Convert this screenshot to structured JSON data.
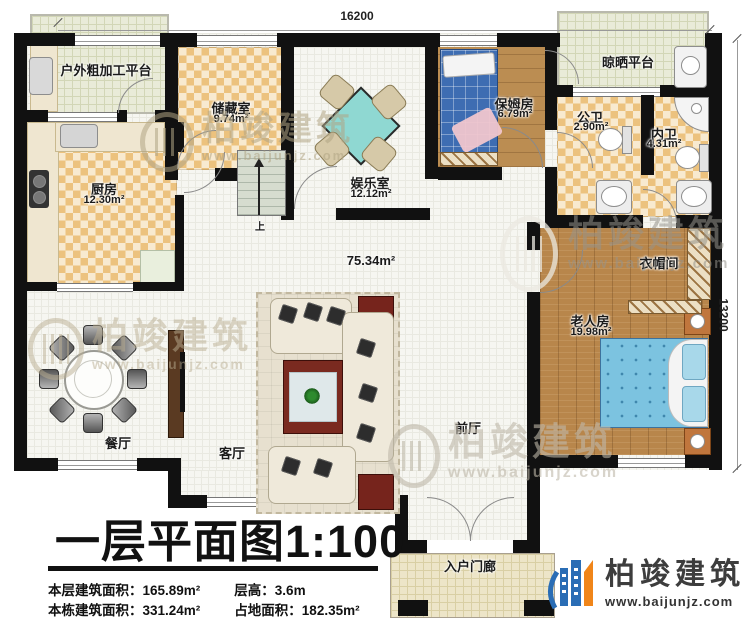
{
  "dimensions": {
    "width_label": "16200",
    "height_label": "13200"
  },
  "rooms": {
    "outdoor_platform": {
      "name": "户外粗加工平台"
    },
    "storage": {
      "name": "储藏室",
      "area": "9.74m²"
    },
    "entertainment": {
      "name": "娱乐室",
      "area": "12.12m²"
    },
    "nanny": {
      "name": "保姆房",
      "area": "6.79m²"
    },
    "drying_platform": {
      "name": "晾晒平台"
    },
    "public_bath": {
      "name": "公卫",
      "area": "2.90m²"
    },
    "inner_bath": {
      "name": "内卫",
      "area": "4.31m²"
    },
    "kitchen": {
      "name": "厨房",
      "area": "12.30m²"
    },
    "cloakroom": {
      "name": "衣帽间"
    },
    "elder_room": {
      "name": "老人房",
      "area": "19.98m²"
    },
    "hall": {
      "area": "75.34m²"
    },
    "dining": {
      "name": "餐厅"
    },
    "living": {
      "name": "客厅"
    },
    "front_hall": {
      "name": "前厅"
    },
    "porch": {
      "name": "入户门廊"
    },
    "stairs": {
      "label": "上"
    }
  },
  "title": {
    "text": "一层平面图",
    "scale": "1:100"
  },
  "stats": {
    "row1": [
      {
        "label": "本层建筑面积：",
        "value": "165.89m²"
      },
      {
        "label": "层高：",
        "value": "3.6m"
      }
    ],
    "row2": [
      {
        "label": "本栋建筑面积：",
        "value": "331.24m²"
      },
      {
        "label": "占地面积：",
        "value": "182.35m²"
      }
    ]
  },
  "logo": {
    "brand": "柏竣建筑",
    "url": "www.baijunjz.com"
  },
  "watermark": {
    "brand": "柏竣建筑",
    "url": "www.baijunjz.com"
  },
  "colors": {
    "wall": "#111111",
    "wood": "#b8864b",
    "checker_dark": "#ecc27e",
    "tile": "#f6f6f1",
    "accent_blue": "#2a6db5",
    "accent_orange": "#f08519",
    "bed_blue": "#7cc3e0",
    "mahjong_teal": "#8fd8d2"
  }
}
